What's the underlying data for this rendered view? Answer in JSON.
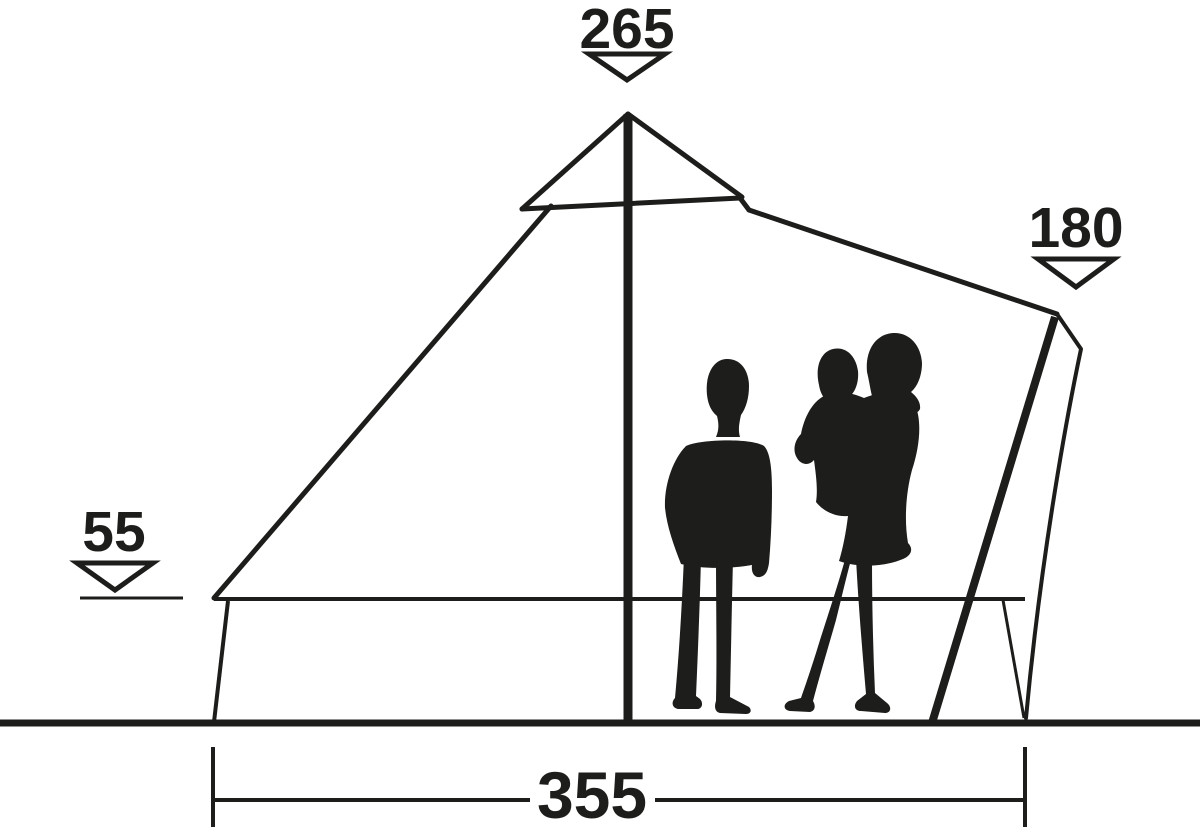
{
  "diagram": {
    "subject": "tent side-profile dimension drawing with family silhouettes"
  },
  "colors": {
    "ink": "#1d1d1b",
    "background": "#ffffff"
  },
  "icons": {
    "peak_arrow": "triangle-down-outline-icon",
    "side_arrow": "triangle-down-outline-icon",
    "wall_arrow": "triangle-down-outline-icon",
    "width_marks": "dimension-line-with-end-ticks"
  },
  "dimensions": {
    "peak_height": "265",
    "side_height": "180",
    "wall_height": "55",
    "floor_width": "355"
  }
}
